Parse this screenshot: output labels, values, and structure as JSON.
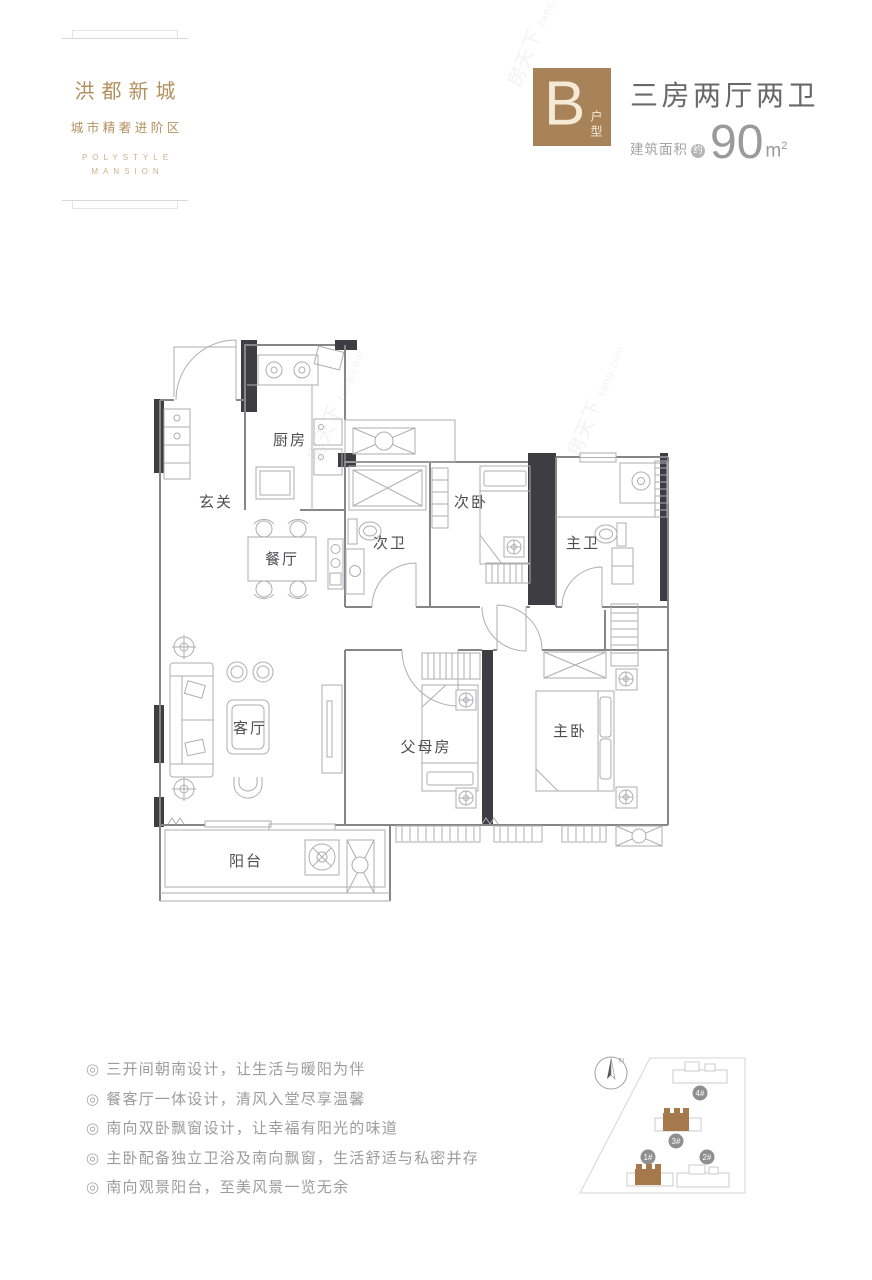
{
  "brand": {
    "name": "洪都新城",
    "tagline": "城市精奢进阶区",
    "en_line1": "POLYSTYLE",
    "en_line2": "MANSION"
  },
  "header": {
    "unit_letter": "B",
    "unit_type_label": "户型",
    "title": "三房两厅两卫",
    "area_prefix": "建筑面积",
    "area_approx": "约",
    "area_value": "90",
    "area_unit": "m",
    "area_sup": "2"
  },
  "floorplan": {
    "rooms": [
      {
        "id": "kitchen",
        "label": "厨房"
      },
      {
        "id": "entry",
        "label": "玄关"
      },
      {
        "id": "dining",
        "label": "餐厅"
      },
      {
        "id": "bath-second",
        "label": "次卫"
      },
      {
        "id": "bed-second",
        "label": "次卧"
      },
      {
        "id": "bath-master",
        "label": "主卫"
      },
      {
        "id": "living",
        "label": "客厅"
      },
      {
        "id": "parents-room",
        "label": "父母房"
      },
      {
        "id": "bed-master",
        "label": "主卧"
      },
      {
        "id": "balcony",
        "label": "阳台"
      }
    ]
  },
  "features": {
    "bullet": "◎",
    "items": [
      "三开间朝南设计，让生活与暖阳为伴",
      "餐客厅一体设计，清风入堂尽享温馨",
      "南向双卧飘窗设计，让幸福有阳光的味道",
      "主卧配备独立卫浴及南向飘窗，生活舒适与私密并存",
      "南向观景阳台，至美风景一览无余"
    ]
  },
  "site_plan": {
    "compass_label": "N",
    "buildings": [
      {
        "label": "4#",
        "highlighted": false
      },
      {
        "label": "3#",
        "highlighted": true
      },
      {
        "label": "1#",
        "highlighted": true
      },
      {
        "label": "2#",
        "highlighted": false
      }
    ]
  },
  "watermark": {
    "text": "房天下",
    "sub": "fang.com"
  },
  "colors": {
    "brand_brown": "#a8835a",
    "logo_gold": "#b3915f",
    "title_gray": "#686868",
    "area_gray": "#9a9a9a",
    "feature_gray": "#9c9c9c",
    "wall_dark": "#3d3d42",
    "badge_gray": "#8f8f8f",
    "building_brown": "#a5794b"
  }
}
